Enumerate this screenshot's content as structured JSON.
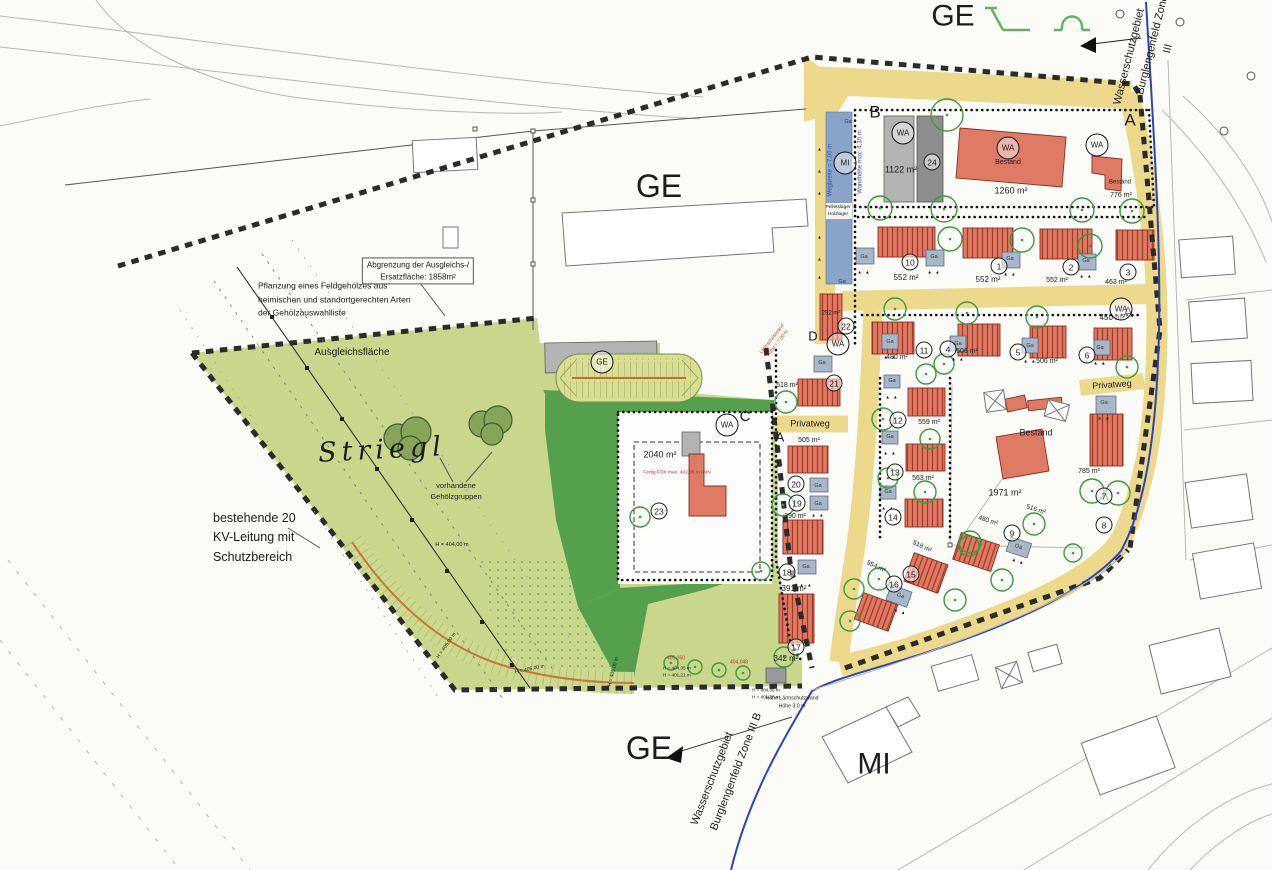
{
  "colors": {
    "road": "#ecd98b",
    "green": "#c8d78b",
    "dark_green": "#55a04c",
    "building_red": "#df7a64",
    "garage": "#a6b7c9",
    "mi_strip": "#8aa3c8",
    "water_line": "#2b46b0",
    "tree": "#3c9b3c"
  },
  "labels_misc": {
    "wa": "WA",
    "mi": "MI",
    "ge": "GE"
  },
  "zone_labels": [
    {
      "t": "GE",
      "x": 659,
      "y": 186,
      "fs": 32,
      "name": "zone-label-ge-central"
    },
    {
      "t": "GE",
      "x": 953,
      "y": 16,
      "fs": 30,
      "name": "zone-label-ge-top"
    },
    {
      "t": "GE",
      "x": 649,
      "y": 748,
      "fs": 32,
      "name": "zone-label-ge-south"
    },
    {
      "t": "MI",
      "x": 874,
      "y": 764,
      "fs": 30,
      "name": "zone-label-mi-south"
    },
    {
      "t": "Striegl",
      "x": 382,
      "y": 450,
      "fs": 27,
      "i": 1,
      "ls": 5,
      "serif": 1,
      "rot": -3,
      "name": "field-name-striegl"
    }
  ],
  "block_letters": [
    {
      "t": "B",
      "x": 875,
      "y": 113,
      "fs": 17,
      "name": "block-label-b"
    },
    {
      "t": "A",
      "x": 1130,
      "y": 121,
      "fs": 17,
      "name": "block-label-a-top"
    },
    {
      "t": "A",
      "x": 1128,
      "y": 313,
      "fs": 15,
      "name": "block-label-a-mid"
    },
    {
      "t": "A",
      "x": 780,
      "y": 438,
      "fs": 13,
      "name": "block-label-a-west"
    },
    {
      "t": "C",
      "x": 745,
      "y": 417,
      "fs": 15,
      "name": "block-label-c"
    },
    {
      "t": "D",
      "x": 813,
      "y": 337,
      "fs": 13,
      "name": "block-label-d"
    }
  ],
  "street_labels": [
    {
      "t": "Privatweg",
      "x": 810,
      "y": 424,
      "fs": 9,
      "name": "street-label-privatweg-west"
    },
    {
      "t": "Privatweg",
      "x": 1112,
      "y": 385,
      "fs": 9,
      "rot": -4,
      "name": "street-label-privatweg-east"
    }
  ],
  "annotations": [
    {
      "t": "Pflanzung eines Feldgehölzes aus\nheimischen und standortgerechten Arten\nder Gehölzauswahlliste",
      "x": 258,
      "y": 300,
      "fs": 8.5,
      "al": "left",
      "lh": 1.6,
      "name": "note-feldgehoelz"
    },
    {
      "t": "Abgrenzung der Ausgleichs-/\nErsatzfläche: 1858m²",
      "x": 418,
      "y": 271,
      "fs": 8,
      "box": 1,
      "name": "note-abgrenzung-ersatzflaeche"
    },
    {
      "t": "Ausgleichsfläche",
      "x": 352,
      "y": 353,
      "fs": 10,
      "name": "note-ausgleichsflaeche"
    },
    {
      "t": "vorhandene\nGehölzgruppen",
      "x": 456,
      "y": 492,
      "fs": 7.5,
      "name": "note-gehoelzgruppen"
    },
    {
      "t": "bestehende 20\nKV-Leitung mit\nSchutzbereich",
      "x": 213,
      "y": 538,
      "fs": 12.5,
      "al": "left",
      "lh": 1.55,
      "name": "note-kv-leitung"
    },
    {
      "t": "H = 404,00 m",
      "x": 452,
      "y": 546,
      "fs": 5.5,
      "name": "elevation-label"
    },
    {
      "t": "H = 405,00 m",
      "x": 447,
      "y": 646,
      "fs": 5,
      "rot": -55,
      "name": "elevation-label"
    },
    {
      "t": "H = 405,00 m",
      "x": 530,
      "y": 670,
      "fs": 5,
      "rot": -12,
      "name": "elevation-label"
    },
    {
      "t": "H = 405,00 m",
      "x": 614,
      "y": 672,
      "fs": 5,
      "rot": -75,
      "name": "elevation-label"
    },
    {
      "t": "405,350",
      "x": 676,
      "y": 659,
      "fs": 5,
      "c": "#b23a2a",
      "name": "elevation-label"
    },
    {
      "t": "404,048",
      "x": 739,
      "y": 663,
      "fs": 5,
      "c": "#b23a2a",
      "name": "elevation-label"
    },
    {
      "t": "H = 404,05 m\nH = 401,21 m",
      "x": 663,
      "y": 672,
      "fs": 4.6,
      "al": "left",
      "name": "elevation-label"
    },
    {
      "t": "H = 404,06 m\nH = 401,20 m",
      "x": 752,
      "y": 694,
      "fs": 4.6,
      "al": "left",
      "name": "elevation-label"
    },
    {
      "t": "Höhe Lärmschutzwand\nHöhe 3,0 m",
      "x": 792,
      "y": 703,
      "fs": 5.2,
      "name": "note-laermschutzwand-sued"
    },
    {
      "t": "Fertig FOK max. 402,95 m üNN",
      "x": 677,
      "y": 474,
      "fs": 4.8,
      "c": "#a33326",
      "name": "note-fok"
    },
    {
      "t": "Wasserschutzgebiet",
      "x": 1130,
      "y": 57,
      "fs": 11,
      "rot": -76,
      "name": "note-wasserschutzgebiet-nord"
    },
    {
      "t": "Burglengenfeld Zone III",
      "x": 1161,
      "y": 47,
      "fs": 11,
      "rot": -76,
      "name": "note-zone-nord"
    },
    {
      "t": "Wasserschutzgebiet",
      "x": 713,
      "y": 779,
      "fs": 11,
      "rot": -69,
      "name": "note-wasserschutzgebiet-sued"
    },
    {
      "t": "Burglengenfeld Zone III B",
      "x": 737,
      "y": 772,
      "fs": 11,
      "rot": -69,
      "name": "note-zone-sued"
    },
    {
      "t": "Wegbreite = 7,00 m",
      "x": 831,
      "y": 170,
      "fs": 6,
      "rot": -90,
      "c": "#3a56a8",
      "name": "note-wegbreite"
    },
    {
      "t": "Wandhöhe max. 4,30 m",
      "x": 861,
      "y": 162,
      "fs": 6,
      "rot": -90,
      "c": "#3a56a8",
      "name": "note-wandhoehe"
    },
    {
      "t": "Pelletslager\nHolzlager",
      "x": 838,
      "y": 212,
      "fs": 4.8,
      "name": "note-pelletslager"
    },
    {
      "t": "Lärmschutzwand\nHöhe = 7,00 m",
      "x": 776,
      "y": 342,
      "fs": 4.8,
      "rot": -52,
      "c": "#c03a2a",
      "name": "note-laermschutzwand-west"
    }
  ],
  "area_labels": [
    {
      "t": "1122 m²",
      "x": 901,
      "y": 170,
      "fs": 9
    },
    {
      "t": "1260 m²",
      "x": 1011,
      "y": 191,
      "fs": 9
    },
    {
      "t": "Bestand",
      "x": 1120,
      "y": 183,
      "fs": 6
    },
    {
      "t": "776 m²",
      "x": 1121,
      "y": 196,
      "fs": 7
    },
    {
      "t": "Bestand",
      "x": 1008,
      "y": 163,
      "fs": 7
    },
    {
      "t": "552 m²",
      "x": 906,
      "y": 278,
      "fs": 8
    },
    {
      "t": "552 m²",
      "x": 988,
      "y": 280,
      "fs": 8
    },
    {
      "t": "552 m²",
      "x": 1057,
      "y": 281,
      "fs": 7
    },
    {
      "t": "463 m²",
      "x": 1116,
      "y": 283,
      "fs": 7
    },
    {
      "t": "480 m²",
      "x": 897,
      "y": 358,
      "fs": 7
    },
    {
      "t": "506 m²",
      "x": 967,
      "y": 352,
      "fs": 7
    },
    {
      "t": "506 m²",
      "x": 1047,
      "y": 362,
      "fs": 7
    },
    {
      "t": "450 m²",
      "x": 1112,
      "y": 318,
      "fs": 8
    },
    {
      "t": "292 m²",
      "x": 831,
      "y": 314,
      "fs": 6
    },
    {
      "t": "518 m²",
      "x": 787,
      "y": 386,
      "fs": 7
    },
    {
      "t": "505 m²",
      "x": 809,
      "y": 441,
      "fs": 7
    },
    {
      "t": "390 m²",
      "x": 795,
      "y": 517,
      "fs": 7
    },
    {
      "t": "391 m²",
      "x": 794,
      "y": 589,
      "fs": 8
    },
    {
      "t": "342 m²",
      "x": 786,
      "y": 659,
      "fs": 8
    },
    {
      "t": "559 m²",
      "x": 929,
      "y": 423,
      "fs": 7
    },
    {
      "t": "563 m²",
      "x": 923,
      "y": 479,
      "fs": 7
    },
    {
      "t": "2040 m²",
      "x": 660,
      "y": 455,
      "fs": 9
    },
    {
      "t": "1971 m²",
      "x": 1005,
      "y": 493,
      "fs": 9
    },
    {
      "t": "Bestand",
      "x": 1036,
      "y": 433,
      "fs": 9
    },
    {
      "t": "785 m²",
      "x": 1089,
      "y": 472,
      "fs": 7
    },
    {
      "t": "480 m²",
      "x": 988,
      "y": 521,
      "fs": 6.5,
      "rot": 18
    },
    {
      "t": "516 m²",
      "x": 1036,
      "y": 510,
      "fs": 6.5,
      "rot": 18
    },
    {
      "t": "518 m²",
      "x": 922,
      "y": 547,
      "fs": 6.5,
      "rot": 25
    },
    {
      "t": "554 m²",
      "x": 876,
      "y": 567,
      "fs": 6.5,
      "rot": 25
    }
  ],
  "ga_labels": [
    {
      "x": 848,
      "y": 123
    },
    {
      "x": 842,
      "y": 283
    },
    {
      "x": 864,
      "y": 258
    },
    {
      "x": 934,
      "y": 258
    },
    {
      "x": 1010,
      "y": 260
    },
    {
      "x": 1086,
      "y": 262
    },
    {
      "x": 890,
      "y": 343
    },
    {
      "x": 958,
      "y": 345
    },
    {
      "x": 1030,
      "y": 347
    },
    {
      "x": 1100,
      "y": 349
    },
    {
      "x": 822,
      "y": 364
    },
    {
      "x": 818,
      "y": 487
    },
    {
      "x": 818,
      "y": 505
    },
    {
      "x": 806,
      "y": 568
    },
    {
      "x": 892,
      "y": 382
    },
    {
      "x": 890,
      "y": 438
    },
    {
      "x": 888,
      "y": 493
    },
    {
      "x": 1104,
      "y": 404
    },
    {
      "x": 900,
      "y": 597,
      "rot": 20
    },
    {
      "x": 1018,
      "y": 548,
      "rot": 18
    }
  ],
  "tri_marks": [
    {
      "t": "▲ ▲",
      "x": 864,
      "y": 273
    },
    {
      "t": "▲ ▲",
      "x": 934,
      "y": 273
    },
    {
      "t": "▲ ▲",
      "x": 1010,
      "y": 275
    },
    {
      "t": "▲ ▲",
      "x": 1086,
      "y": 277
    },
    {
      "t": "▲ ▲",
      "x": 890,
      "y": 358
    },
    {
      "t": "▲ ▲",
      "x": 958,
      "y": 360
    },
    {
      "t": "▲ ▲",
      "x": 1030,
      "y": 362
    },
    {
      "t": "▲ ▲",
      "x": 1100,
      "y": 364
    },
    {
      "t": "▲ ▲",
      "x": 818,
      "y": 516
    },
    {
      "t": "▲ ▲",
      "x": 806,
      "y": 586
    },
    {
      "t": "▲ ▲",
      "x": 892,
      "y": 398
    },
    {
      "t": "▲ ▲",
      "x": 890,
      "y": 454
    },
    {
      "t": "▲ ▲",
      "x": 888,
      "y": 509
    },
    {
      "t": "▲ ▲",
      "x": 1104,
      "y": 419
    },
    {
      "t": "▲ ▲",
      "x": 900,
      "y": 612,
      "rot": 20
    },
    {
      "t": "▲ ▲",
      "x": 1018,
      "y": 562,
      "rot": 18
    },
    {
      "t": "▲",
      "x": 820,
      "y": 150
    },
    {
      "t": "▲",
      "x": 820,
      "y": 172
    },
    {
      "t": "▲",
      "x": 820,
      "y": 194
    },
    {
      "t": "▲",
      "x": 820,
      "y": 238
    },
    {
      "t": "▲",
      "x": 820,
      "y": 260
    },
    {
      "t": "▲",
      "x": 820,
      "y": 278
    }
  ],
  "plot_numbers": [
    {
      "n": "1",
      "x": 999,
      "y": 266
    },
    {
      "n": "2",
      "x": 1071,
      "y": 267
    },
    {
      "n": "3",
      "x": 1128,
      "y": 272
    },
    {
      "n": "4",
      "x": 948,
      "y": 349
    },
    {
      "n": "5",
      "x": 1018,
      "y": 352
    },
    {
      "n": "6",
      "x": 1087,
      "y": 355
    },
    {
      "n": "7",
      "x": 1104,
      "y": 496
    },
    {
      "n": "8",
      "x": 1104,
      "y": 525
    },
    {
      "n": "9",
      "x": 1012,
      "y": 533
    },
    {
      "n": "10",
      "x": 910,
      "y": 262
    },
    {
      "n": "11",
      "x": 924,
      "y": 350
    },
    {
      "n": "12",
      "x": 898,
      "y": 420
    },
    {
      "n": "13",
      "x": 895,
      "y": 472
    },
    {
      "n": "14",
      "x": 893,
      "y": 517
    },
    {
      "n": "15",
      "x": 911,
      "y": 574
    },
    {
      "n": "16",
      "x": 894,
      "y": 584
    },
    {
      "n": "17",
      "x": 796,
      "y": 647
    },
    {
      "n": "18",
      "x": 787,
      "y": 572
    },
    {
      "n": "19",
      "x": 797,
      "y": 503
    },
    {
      "n": "20",
      "x": 796,
      "y": 484
    },
    {
      "n": "21",
      "x": 834,
      "y": 383
    },
    {
      "n": "22",
      "x": 846,
      "y": 326
    },
    {
      "n": "23",
      "x": 659,
      "y": 511
    },
    {
      "n": "24",
      "x": 932,
      "y": 162
    }
  ],
  "wa_circles": [
    {
      "x": 903,
      "y": 133
    },
    {
      "x": 1097,
      "y": 145
    },
    {
      "x": 1121,
      "y": 309
    },
    {
      "x": 838,
      "y": 344
    },
    {
      "x": 727,
      "y": 425
    },
    {
      "x": 1008,
      "y": 148
    }
  ],
  "mi_circle": {
    "x": 845,
    "y": 163
  },
  "ge_circle": {
    "x": 602,
    "y": 362
  },
  "trees": [
    {
      "x": 947,
      "y": 115,
      "r": 16
    },
    {
      "x": 880,
      "y": 208,
      "r": 12
    },
    {
      "x": 944,
      "y": 209,
      "r": 13
    },
    {
      "x": 1082,
      "y": 210,
      "r": 12
    },
    {
      "x": 1132,
      "y": 211,
      "r": 12
    },
    {
      "x": 950,
      "y": 239,
      "r": 12
    },
    {
      "x": 1022,
      "y": 240,
      "r": 12
    },
    {
      "x": 1090,
      "y": 246,
      "r": 12
    },
    {
      "x": 895,
      "y": 309,
      "r": 11
    },
    {
      "x": 967,
      "y": 313,
      "r": 11
    },
    {
      "x": 1037,
      "y": 317,
      "r": 11
    },
    {
      "x": 944,
      "y": 364,
      "r": 10
    },
    {
      "x": 926,
      "y": 374,
      "r": 10
    },
    {
      "x": 1127,
      "y": 367,
      "r": 11
    },
    {
      "x": 786,
      "y": 402,
      "r": 11
    },
    {
      "x": 783,
      "y": 505,
      "r": 11
    },
    {
      "x": 761,
      "y": 571,
      "r": 9
    },
    {
      "x": 784,
      "y": 657,
      "r": 10
    },
    {
      "x": 883,
      "y": 419,
      "r": 11
    },
    {
      "x": 930,
      "y": 439,
      "r": 10
    },
    {
      "x": 888,
      "y": 478,
      "r": 10
    },
    {
      "x": 925,
      "y": 492,
      "r": 11
    },
    {
      "x": 1092,
      "y": 491,
      "r": 12
    },
    {
      "x": 1118,
      "y": 493,
      "r": 12
    },
    {
      "x": 1034,
      "y": 524,
      "r": 11
    },
    {
      "x": 970,
      "y": 542,
      "r": 11
    },
    {
      "x": 969,
      "y": 546,
      "r": 10
    },
    {
      "x": 879,
      "y": 579,
      "r": 11
    },
    {
      "x": 854,
      "y": 589,
      "r": 10
    },
    {
      "x": 850,
      "y": 621,
      "r": 10
    },
    {
      "x": 955,
      "y": 600,
      "r": 11
    },
    {
      "x": 1002,
      "y": 580,
      "r": 11
    },
    {
      "x": 1073,
      "y": 553,
      "r": 9
    },
    {
      "x": 640,
      "y": 517,
      "r": 10
    },
    {
      "x": 671,
      "y": 663,
      "r": 7
    },
    {
      "x": 695,
      "y": 667,
      "r": 7
    },
    {
      "x": 719,
      "y": 670,
      "r": 7
    },
    {
      "x": 743,
      "y": 673,
      "r": 7
    }
  ]
}
